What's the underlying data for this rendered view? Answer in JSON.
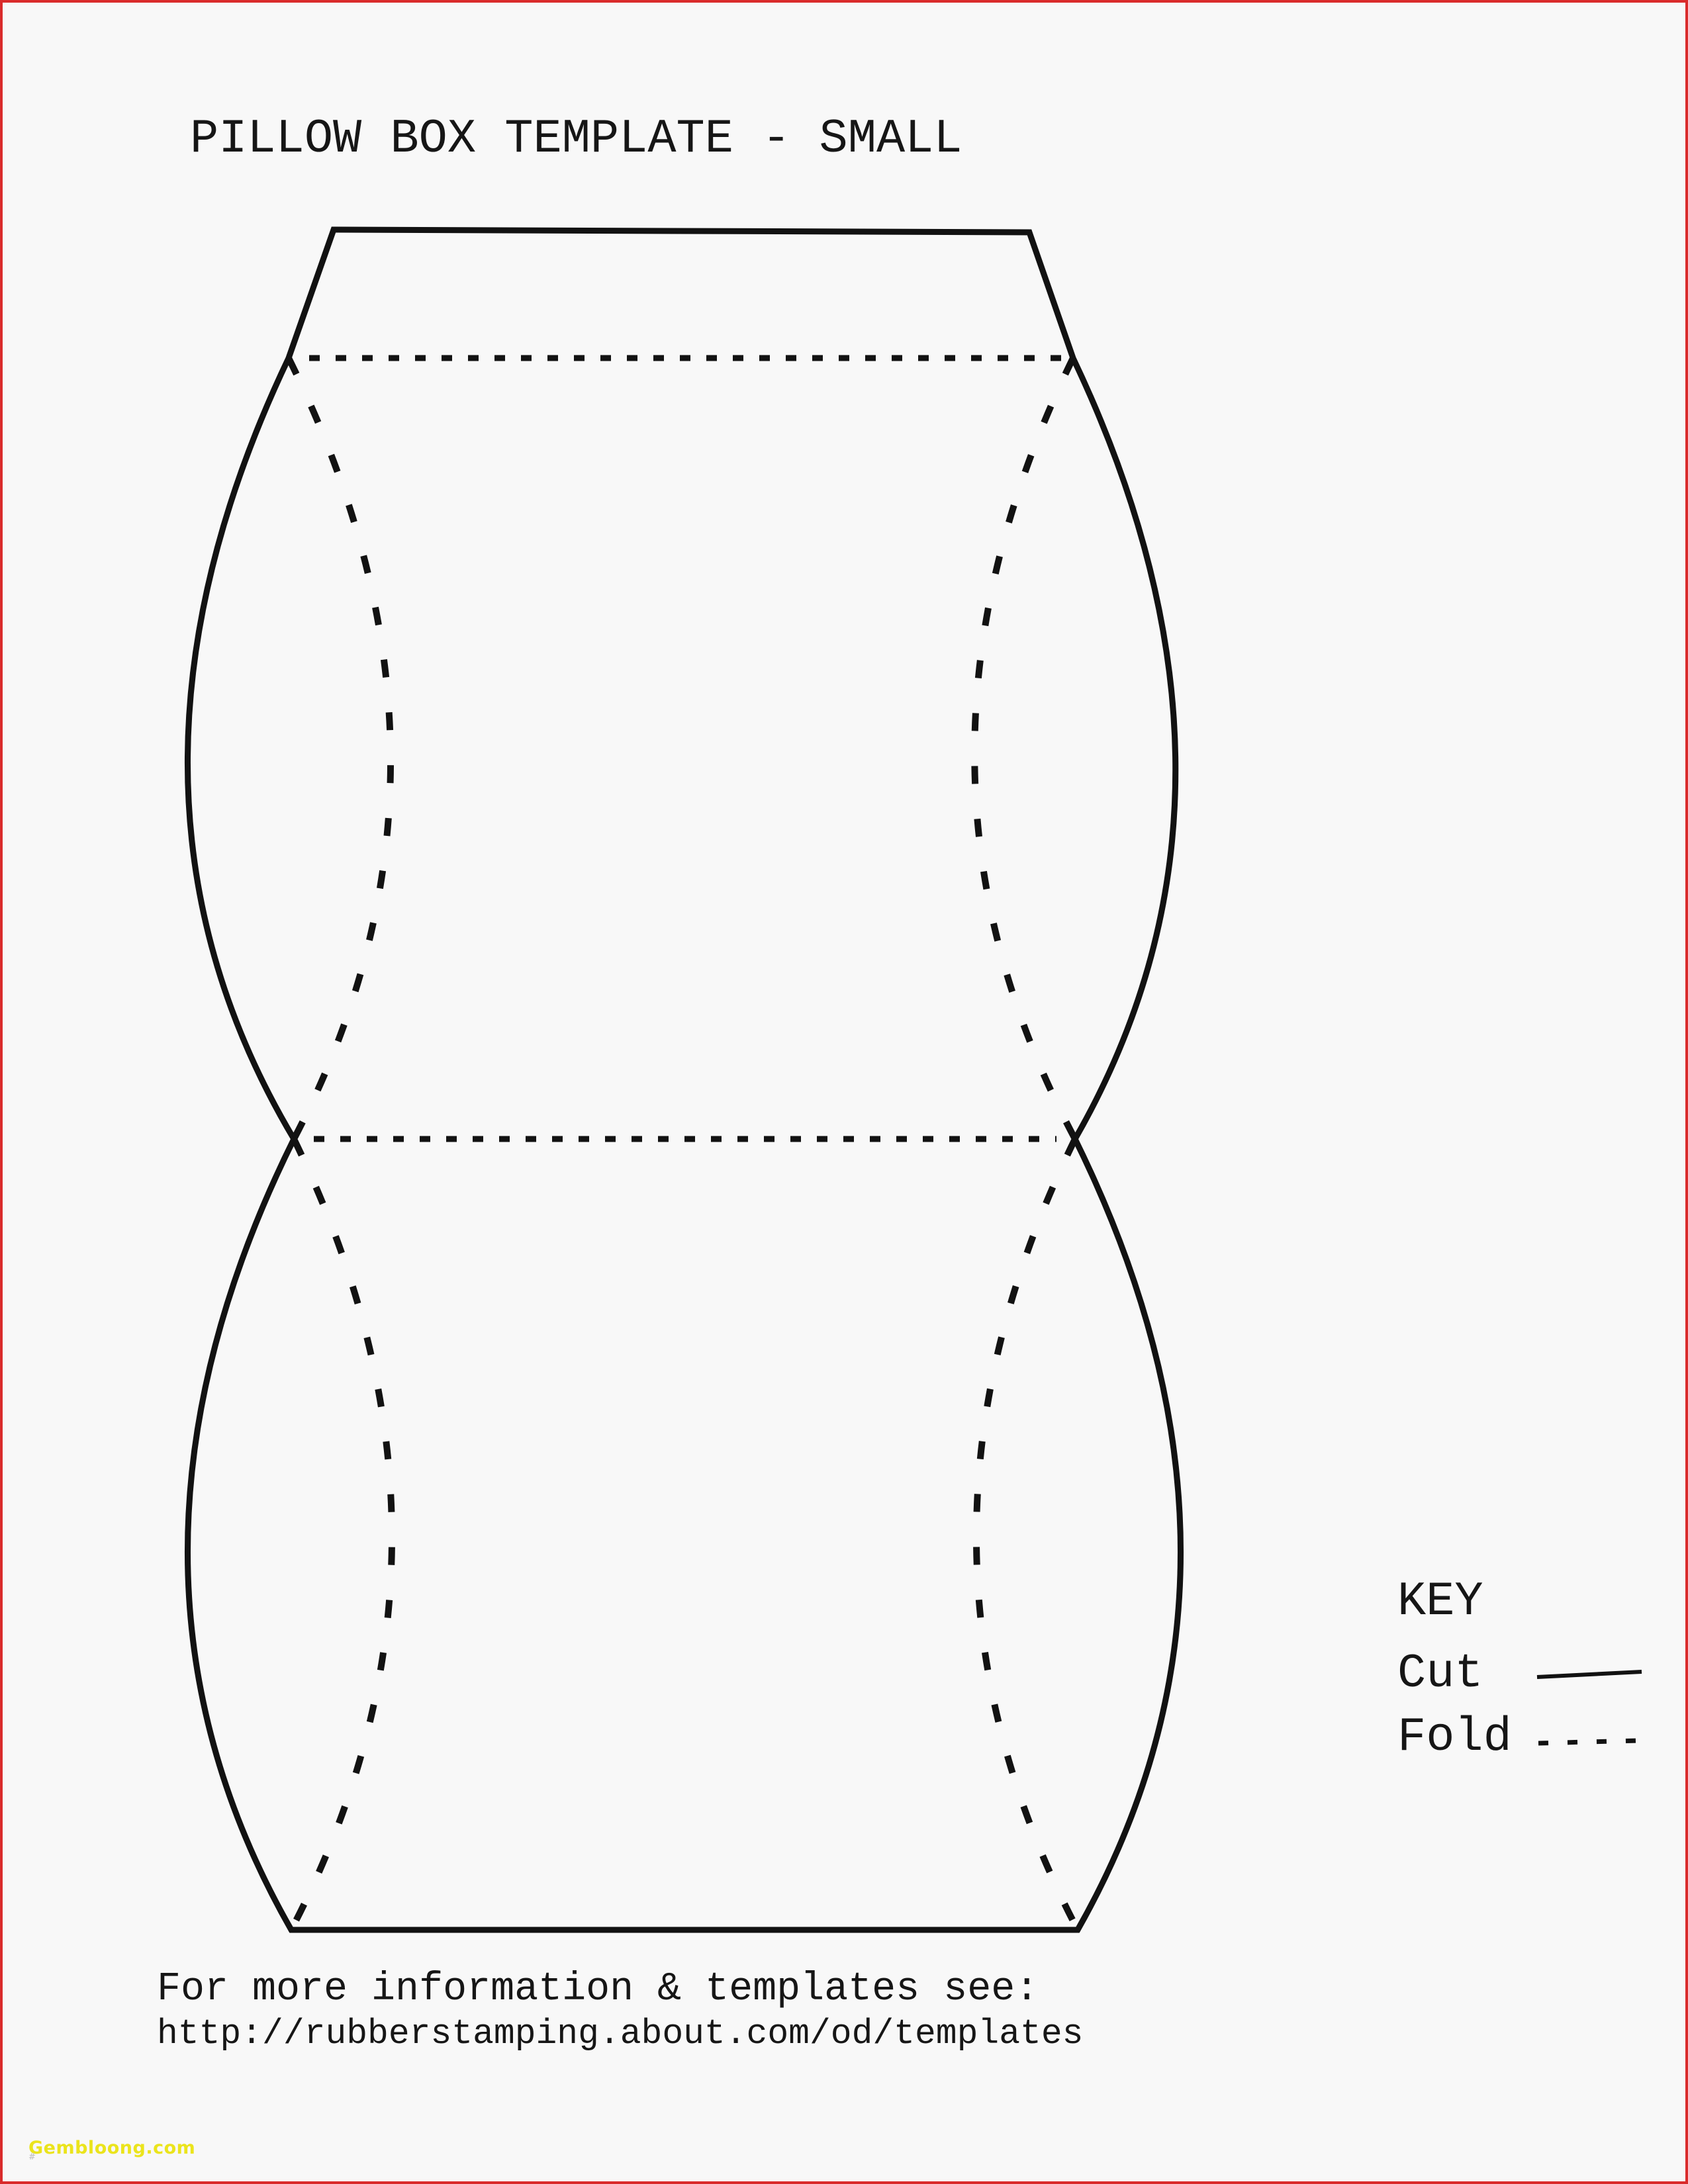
{
  "page": {
    "title": "PILLOW BOX TEMPLATE - SMALL",
    "background_color": "#f8f8f8",
    "border_color": "#d92b2b"
  },
  "diagram": {
    "name": "pillow-box-net",
    "line_color": "#121212",
    "line_styles": {
      "cut": "solid",
      "fold": "dashed"
    }
  },
  "key": {
    "heading": "KEY",
    "items": [
      {
        "label": "Cut",
        "style": "solid"
      },
      {
        "label": "Fold",
        "style": "dashed"
      }
    ]
  },
  "footer": {
    "note": "For more information & templates see:",
    "url": "http://rubberstamping.about.com/od/templates"
  },
  "watermark": {
    "text": "Gembloong.com",
    "color": "#ebe41c",
    "corner_mark": "#"
  }
}
